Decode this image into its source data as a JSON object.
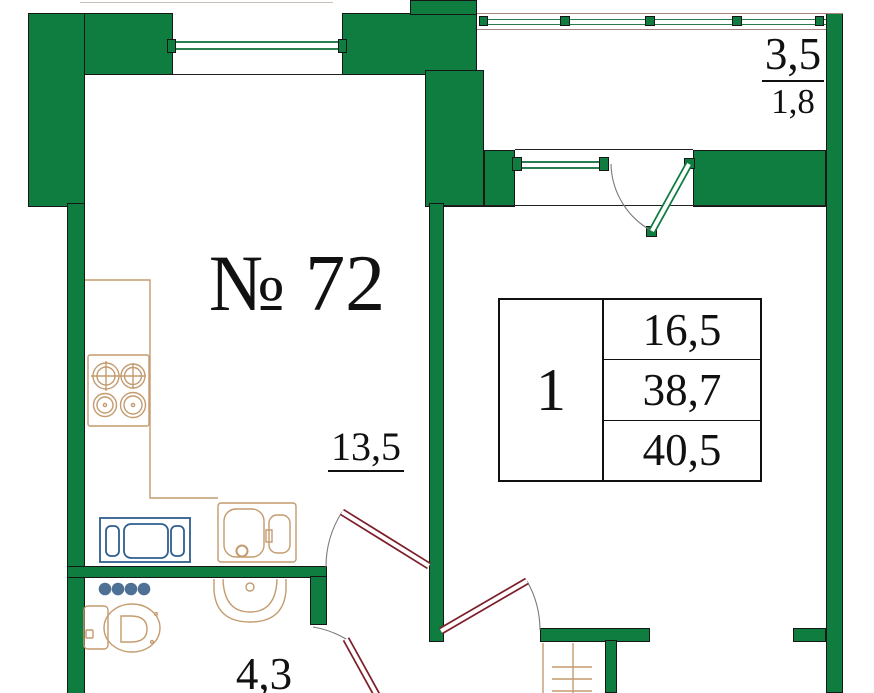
{
  "plan": {
    "apartment_number": "№ 72",
    "areas": {
      "kitchen_living_room": "13,5",
      "bathroom": "4,3",
      "balcony": "3,5",
      "balcony_counted": "1,8"
    },
    "summary_table": {
      "rooms": "1",
      "living_area": "16,5",
      "total_area": "38,7",
      "total_area_with_balcony": "40,5"
    },
    "colors": {
      "wall": "#0f7c40",
      "window": "#2a7d4f",
      "door": "#7e1f2a",
      "fixture": "#c49b6e",
      "appliance": "#2e5e8e",
      "dots": "#4f7095",
      "glazing": "#a8837d",
      "ink": "#111111"
    }
  }
}
